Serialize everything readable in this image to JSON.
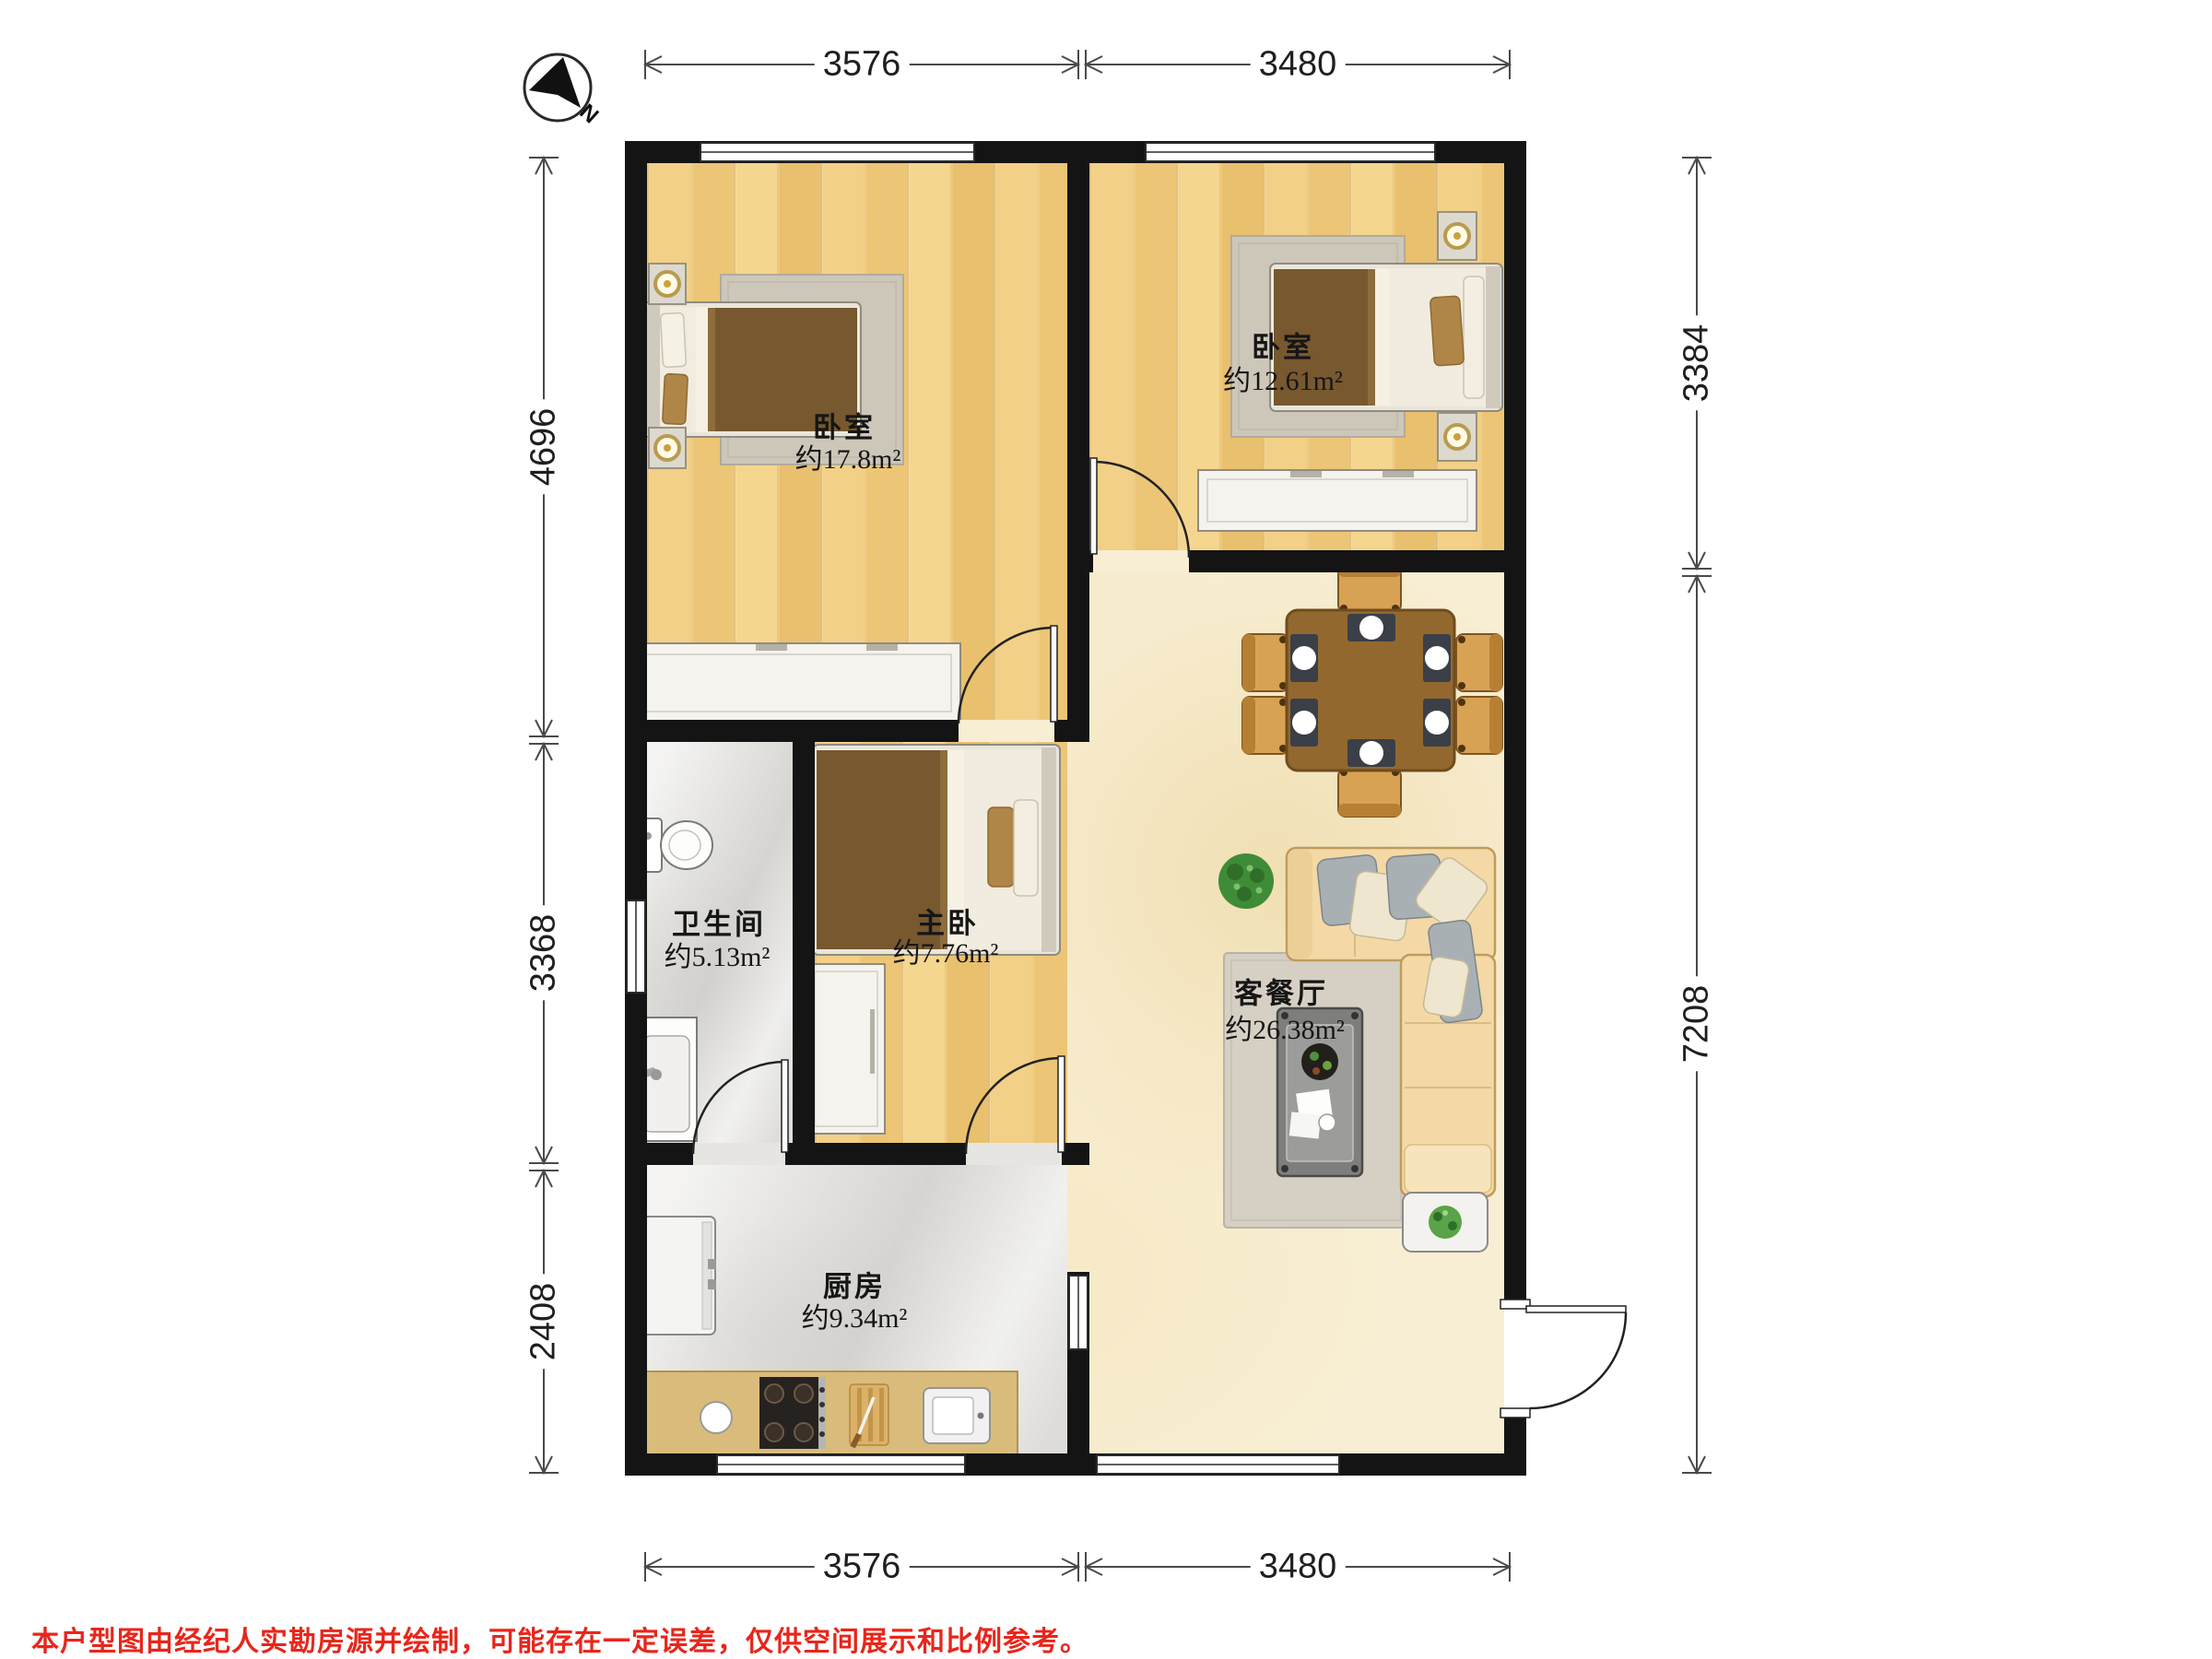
{
  "compass": {
    "label": "N"
  },
  "dimensions": {
    "top": [
      "3576",
      "3480"
    ],
    "bottom": [
      "3576",
      "3480"
    ],
    "left": [
      "4696",
      "3368",
      "2408"
    ],
    "right": [
      "3384",
      "7208"
    ]
  },
  "rooms": {
    "bedroom_a": {
      "name": "卧室",
      "area": "约17.8m²"
    },
    "bedroom_b": {
      "name": "卧室",
      "area": "约12.61m²"
    },
    "bathroom": {
      "name": "卫生间",
      "area": "约5.13m²"
    },
    "master": {
      "name": "主卧",
      "area": "约7.76m²"
    },
    "living": {
      "name": "客餐厅",
      "area": "约26.38m²"
    },
    "kitchen": {
      "name": "厨房",
      "area": "约9.34m²"
    }
  },
  "disclaimer": "本户型图由经纪人实勘房源并绘制，可能存在一定误差，仅供空间展示和比例参考。",
  "colors": {
    "wall": "#141414",
    "wood_floor": "#efcb7c",
    "tile_floor": "#e6e5e2",
    "living_floor": "#f8eed3",
    "counter_tan": "#d9bc7c",
    "blanket_brown": "#77582f",
    "sofa_tan": "#f4d9a6",
    "table_brown": "#93682e",
    "plant_green": "#3f8c38",
    "disclaimer_red": "#e8261b"
  }
}
